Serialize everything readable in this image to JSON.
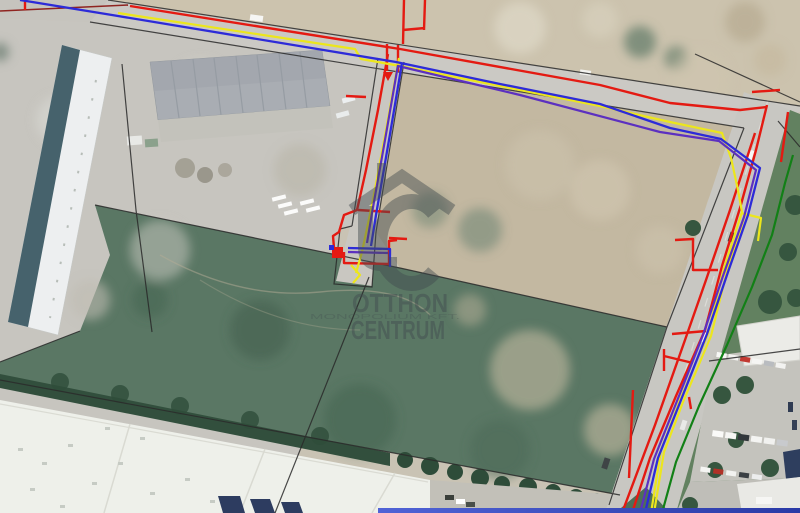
{
  "map": {
    "layers": [
      "aerial-satellite-imagery",
      "parcel-boundary-lines",
      "utility-line-red",
      "utility-line-yellow",
      "utility-line-blue",
      "utility-line-purple",
      "utility-line-green",
      "agency-watermark"
    ]
  },
  "watermark": {
    "line1": "OTTHON",
    "line2": "CENTRUM",
    "small_print": "MONOPOLIUM KFT.",
    "logo": "otthon-centrum-house-logo"
  },
  "colors": {
    "utility_red": "#e41a12",
    "utility_dark_red": "#8f2420",
    "utility_yellow": "#ece61c",
    "utility_blue": "#2d2bd8",
    "utility_purple": "#5c30c0",
    "utility_green": "#128016",
    "parcel_line": "#2a2a2a",
    "watermark_gray": "#414a4e",
    "bottom_bar_left": "#5063d6",
    "bottom_bar_right": "#2a3aa6"
  }
}
